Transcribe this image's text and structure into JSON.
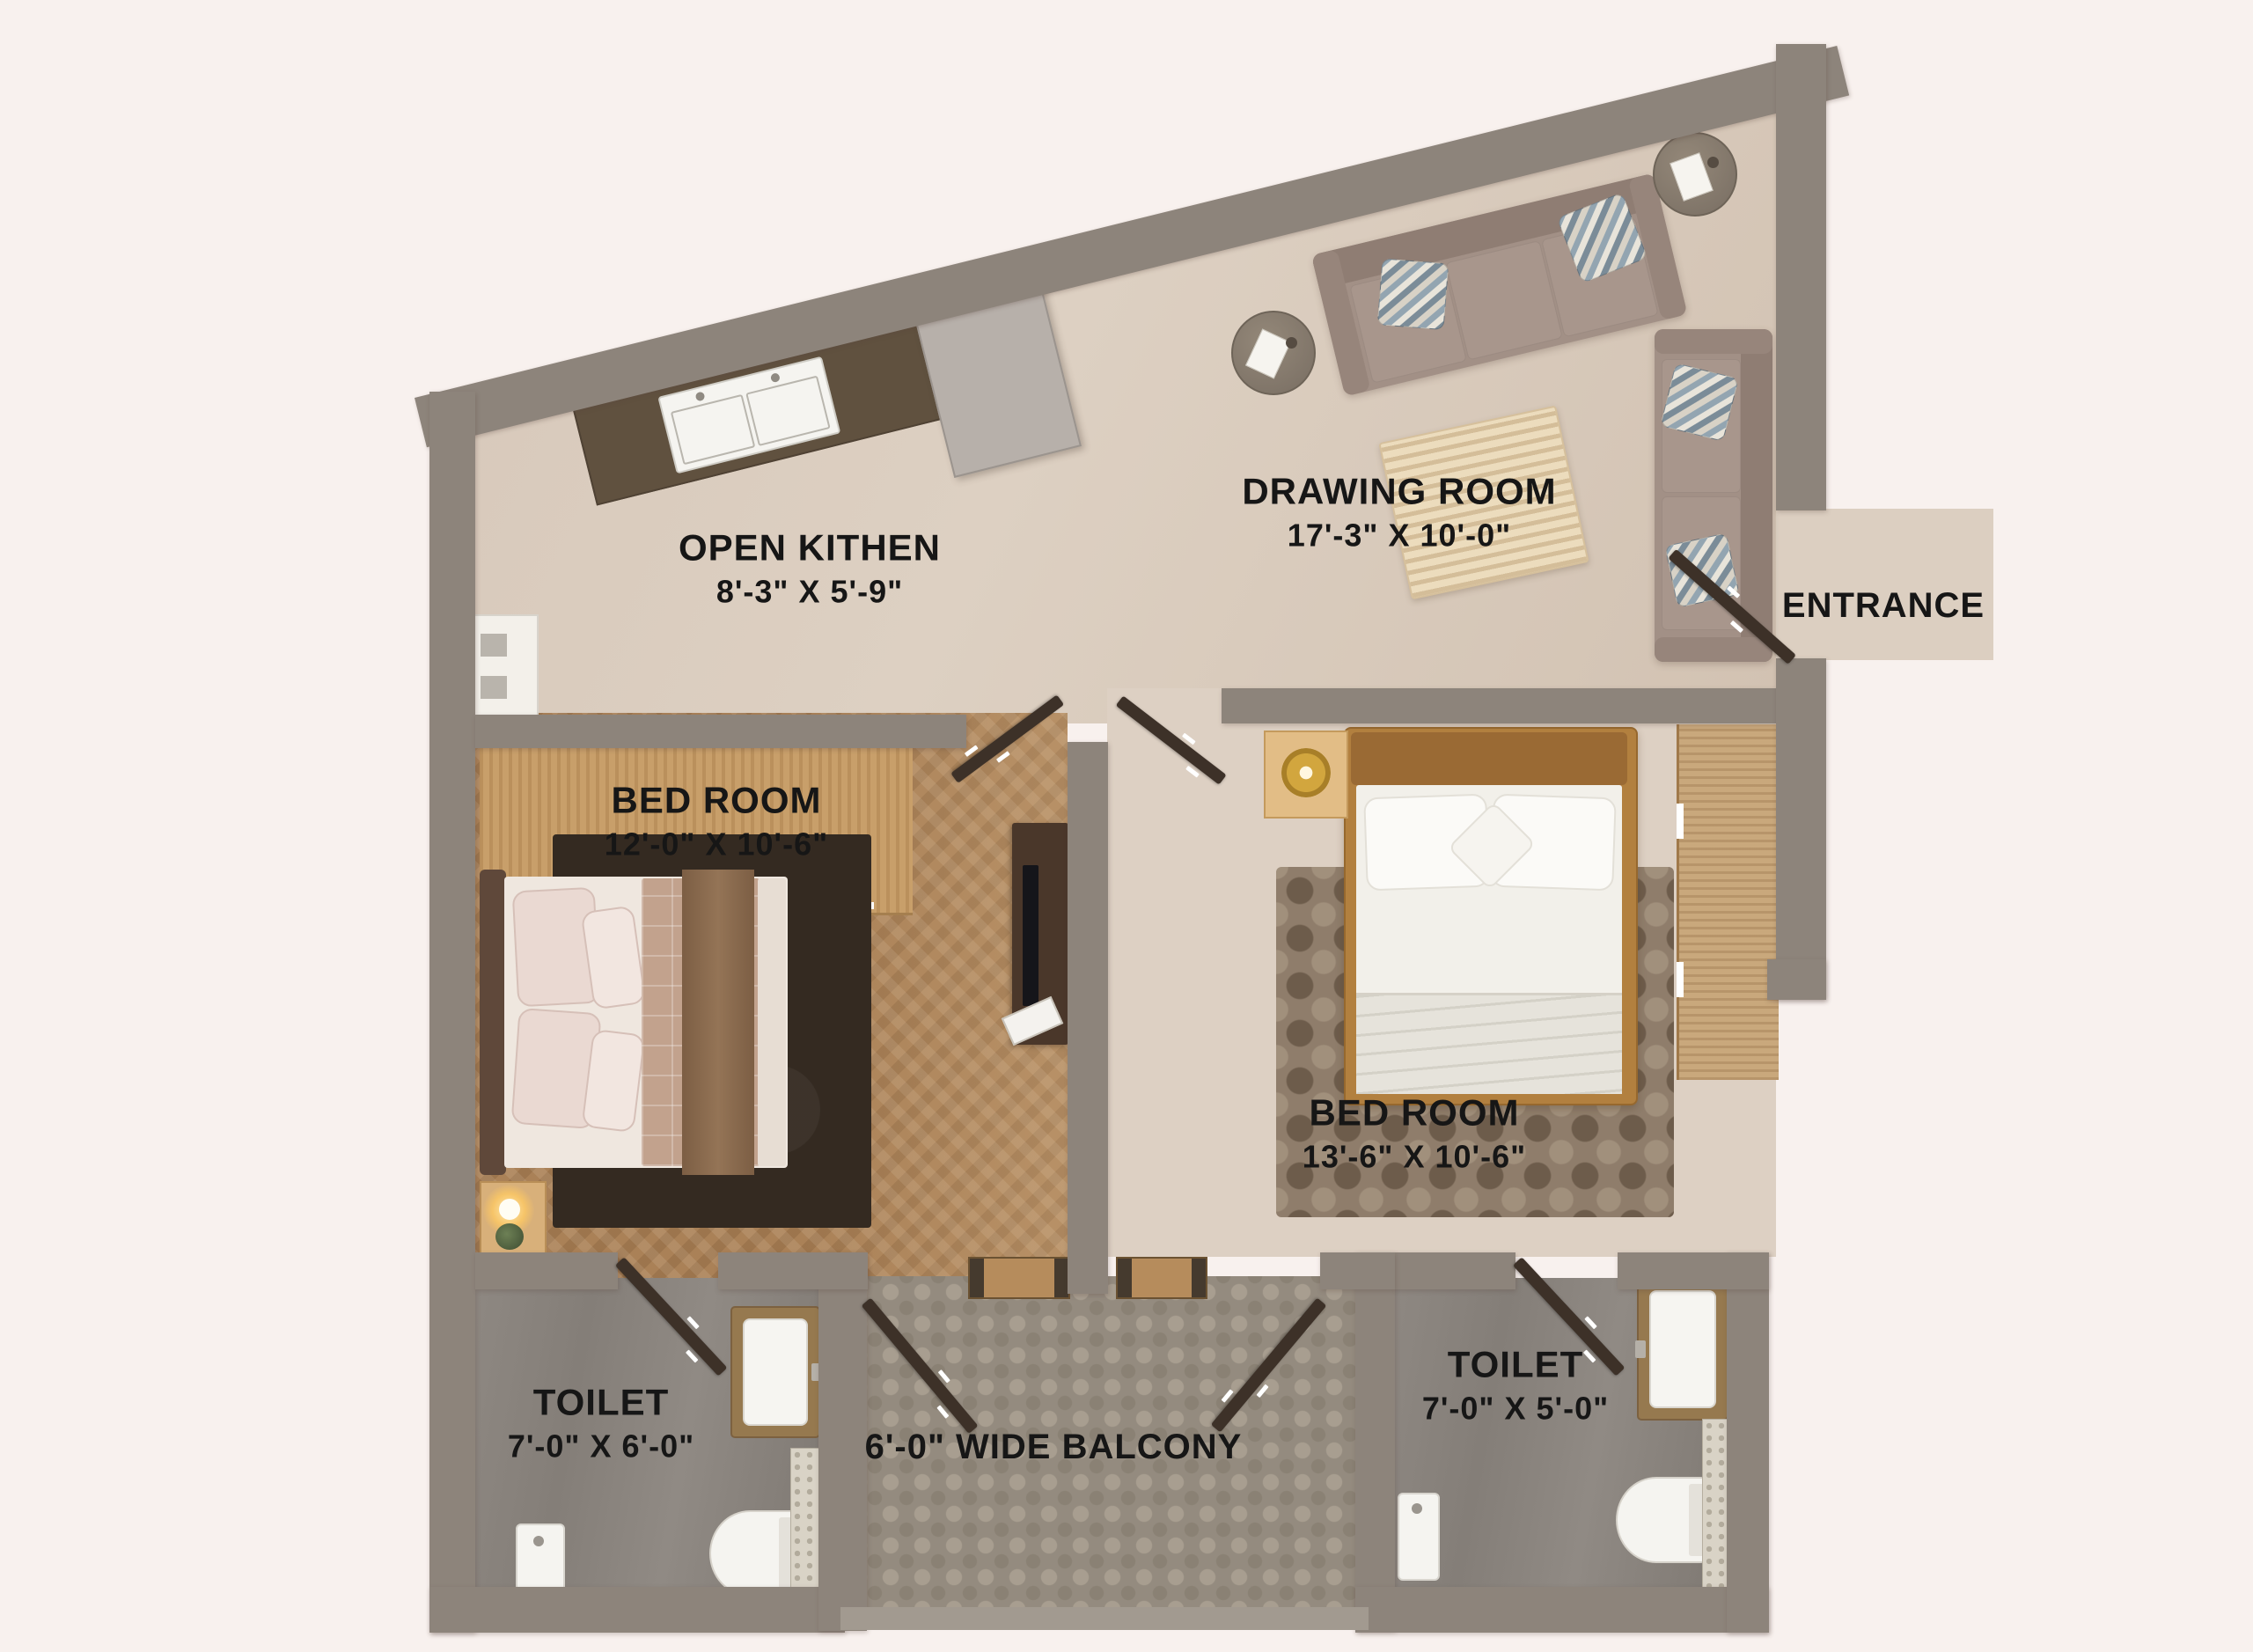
{
  "rooms": {
    "drawing_room": {
      "name": "DRAWING ROOM",
      "dims": "17'-3\" X 10'-0\""
    },
    "open_kitchen": {
      "name": "OPEN KITHEN",
      "dims": "8'-3\" X 5'-9\""
    },
    "bedroom_left": {
      "name": "BED ROOM",
      "dims": "12'-0\" X 10'-6\""
    },
    "bedroom_right": {
      "name": "BED ROOM",
      "dims": "13'-6\" X 10'-6\""
    },
    "toilet_left": {
      "name": "TOILET",
      "dims": "7'-0\" X 6'-0\""
    },
    "toilet_right": {
      "name": "TOILET",
      "dims": "7'-0\" X 5'-0\""
    },
    "balcony": {
      "label": "6'-0\" WIDE BALCONY"
    },
    "entrance": {
      "label": "ENTRANCE"
    }
  },
  "colors": {
    "background": "#f8f1ee",
    "wall": "#8d847b",
    "floor_beige": "#d7c8ba",
    "floor_wood": "#aa8157",
    "floor_tile": "#948b7f",
    "floor_toilet": "#86807a",
    "door_leaf": "#3d3128",
    "label_text": "#161616"
  }
}
